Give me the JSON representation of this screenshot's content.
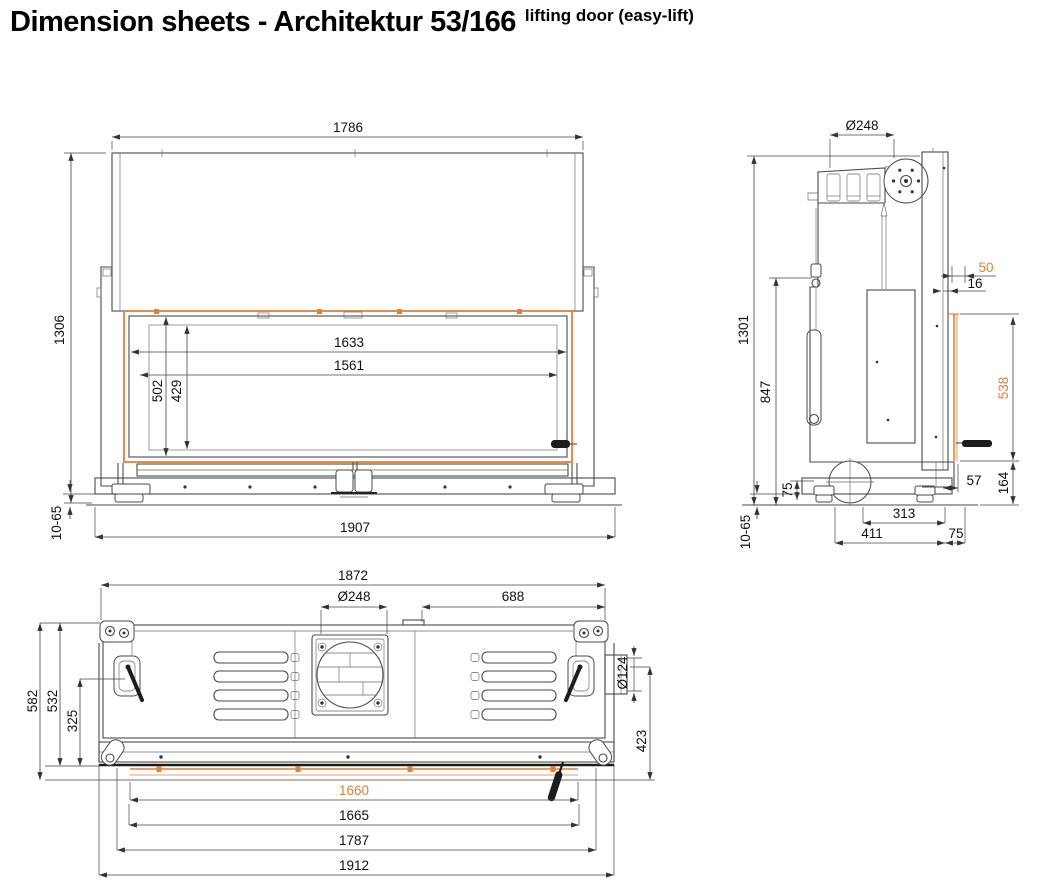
{
  "title": {
    "main": "Dimension sheets - Architektur 53/166",
    "superscript": "lifting door (easy-lift)"
  },
  "colors": {
    "accent": "#E0813C",
    "line": "#4A4A4A",
    "dim_text": "#111111"
  },
  "views": {
    "front": {
      "overall_width": "1786",
      "overall_height": "1306",
      "door_frame_width": "1633",
      "glass_width": "1561",
      "door_frame_height": "502",
      "glass_height": "429",
      "base_width": "1907",
      "floor_clearance": "10-65"
    },
    "side": {
      "flue_diameter": "Ø248",
      "overall_height": "1301",
      "body_height": "847",
      "wall_offset": "50",
      "frame_offset": "16",
      "glass_height": "538",
      "sill_height": "164",
      "frame_depth": "57",
      "foot_height": "75",
      "air_inlet_offset": "313",
      "base_depth": "411",
      "front_offset": "75",
      "floor_clearance": "10-65"
    },
    "top": {
      "overall_width": "1872",
      "flue_diameter": "Ø248",
      "flue_to_side": "688",
      "overall_depth": "582",
      "body_depth": "532",
      "inner_depth": "325",
      "side_outlet_diameter": "Ø124",
      "front_depth": "423",
      "glass_width": "1660",
      "opening_width": "1665",
      "front_width": "1787",
      "base_width": "1912"
    }
  }
}
